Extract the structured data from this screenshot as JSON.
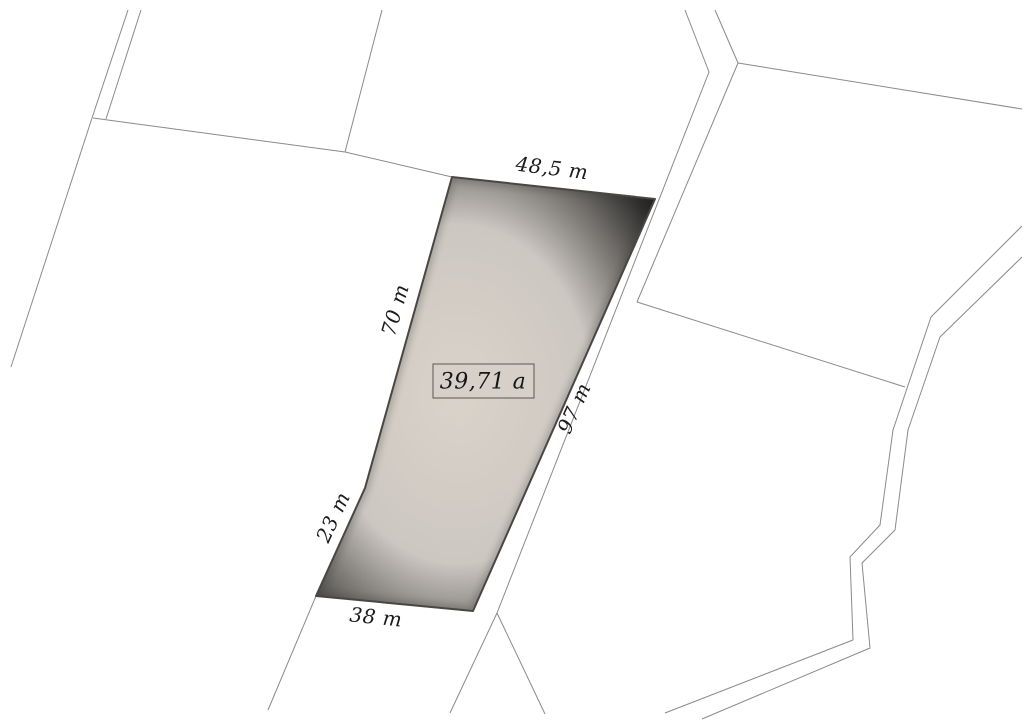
{
  "parcel": {
    "area_label": "39,71 a",
    "measurements": {
      "top": "48,5 m",
      "left": "70 m",
      "right": "97 m",
      "lower_left": "23 m",
      "bottom": "38 m"
    }
  },
  "colors": {
    "background": "#ffffff",
    "parcel_fill_center": "#d9d2c9",
    "parcel_fill_mid": "#c8c3bd",
    "parcel_fill_edge": "#aeabа9",
    "parcel_border": "#4b4945",
    "boundary_line": "#8a8a8a",
    "label_text": "#1b1b1b",
    "area_box_fill": "#d6d0c9",
    "area_box_border": "#5a5751"
  }
}
